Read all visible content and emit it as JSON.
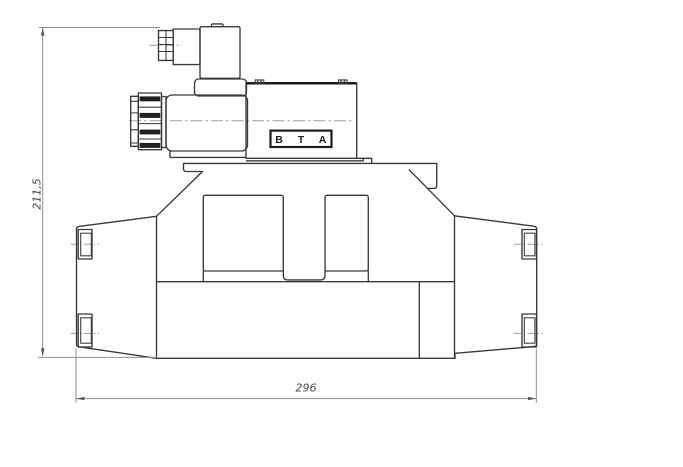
{
  "drawing": {
    "kind": "engineering-drawing-solenoid-valve-side-view",
    "dimensions": {
      "height_label": "211,5",
      "width_label": "296"
    },
    "port_labels": {
      "b": "B",
      "t": "T",
      "a": "A"
    },
    "colors": {
      "background": "#ffffff",
      "outline": "#3a3a3a",
      "outline_dark": "#1c1c1c",
      "dimension_line": "#8f8f8f",
      "centerline": "#9aa0a3",
      "dimension_text": "#4a4a4a"
    }
  }
}
